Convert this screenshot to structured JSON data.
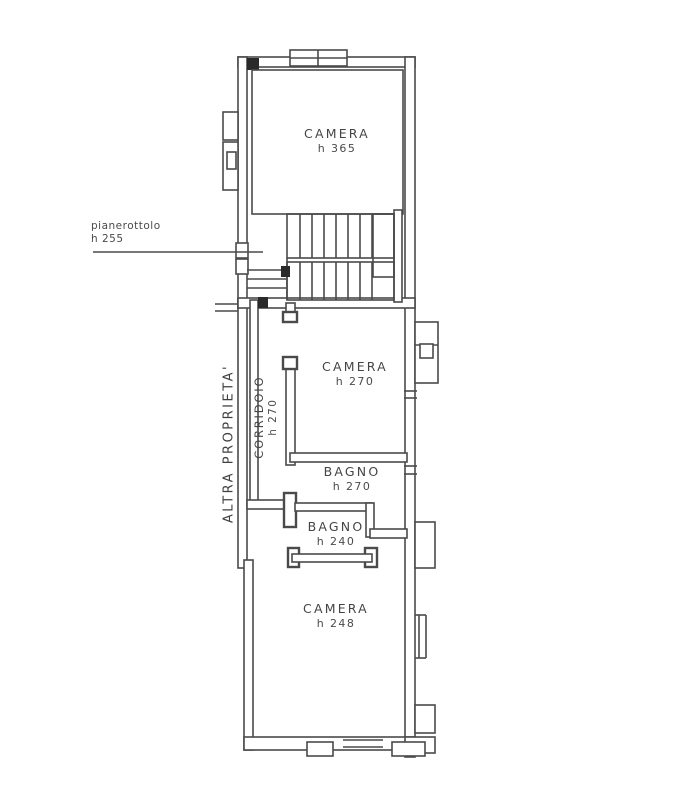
{
  "title": "Planimetria piano",
  "colors": {
    "line": "#4a4a4a",
    "ink": "#3f3f3f",
    "bg": "#ffffff"
  },
  "rooms": [
    {
      "id": "camera-top",
      "name": "CAMERA",
      "height": "h 365"
    },
    {
      "id": "camera-mid",
      "name": "CAMERA",
      "height": "h 270"
    },
    {
      "id": "bagno-upper",
      "name": "BAGNO",
      "height": "h 270"
    },
    {
      "id": "bagno-lower",
      "name": "BAGNO",
      "height": "h 240"
    },
    {
      "id": "camera-bottom",
      "name": "CAMERA",
      "height": "h 248"
    },
    {
      "id": "corridoio",
      "name": "CORRIDOIO",
      "height": "h 270"
    }
  ],
  "annotations": {
    "landing": {
      "name": "pianerottolo",
      "height": "h 255"
    },
    "adjacent_property": "ALTRA PROPRIETA'"
  }
}
